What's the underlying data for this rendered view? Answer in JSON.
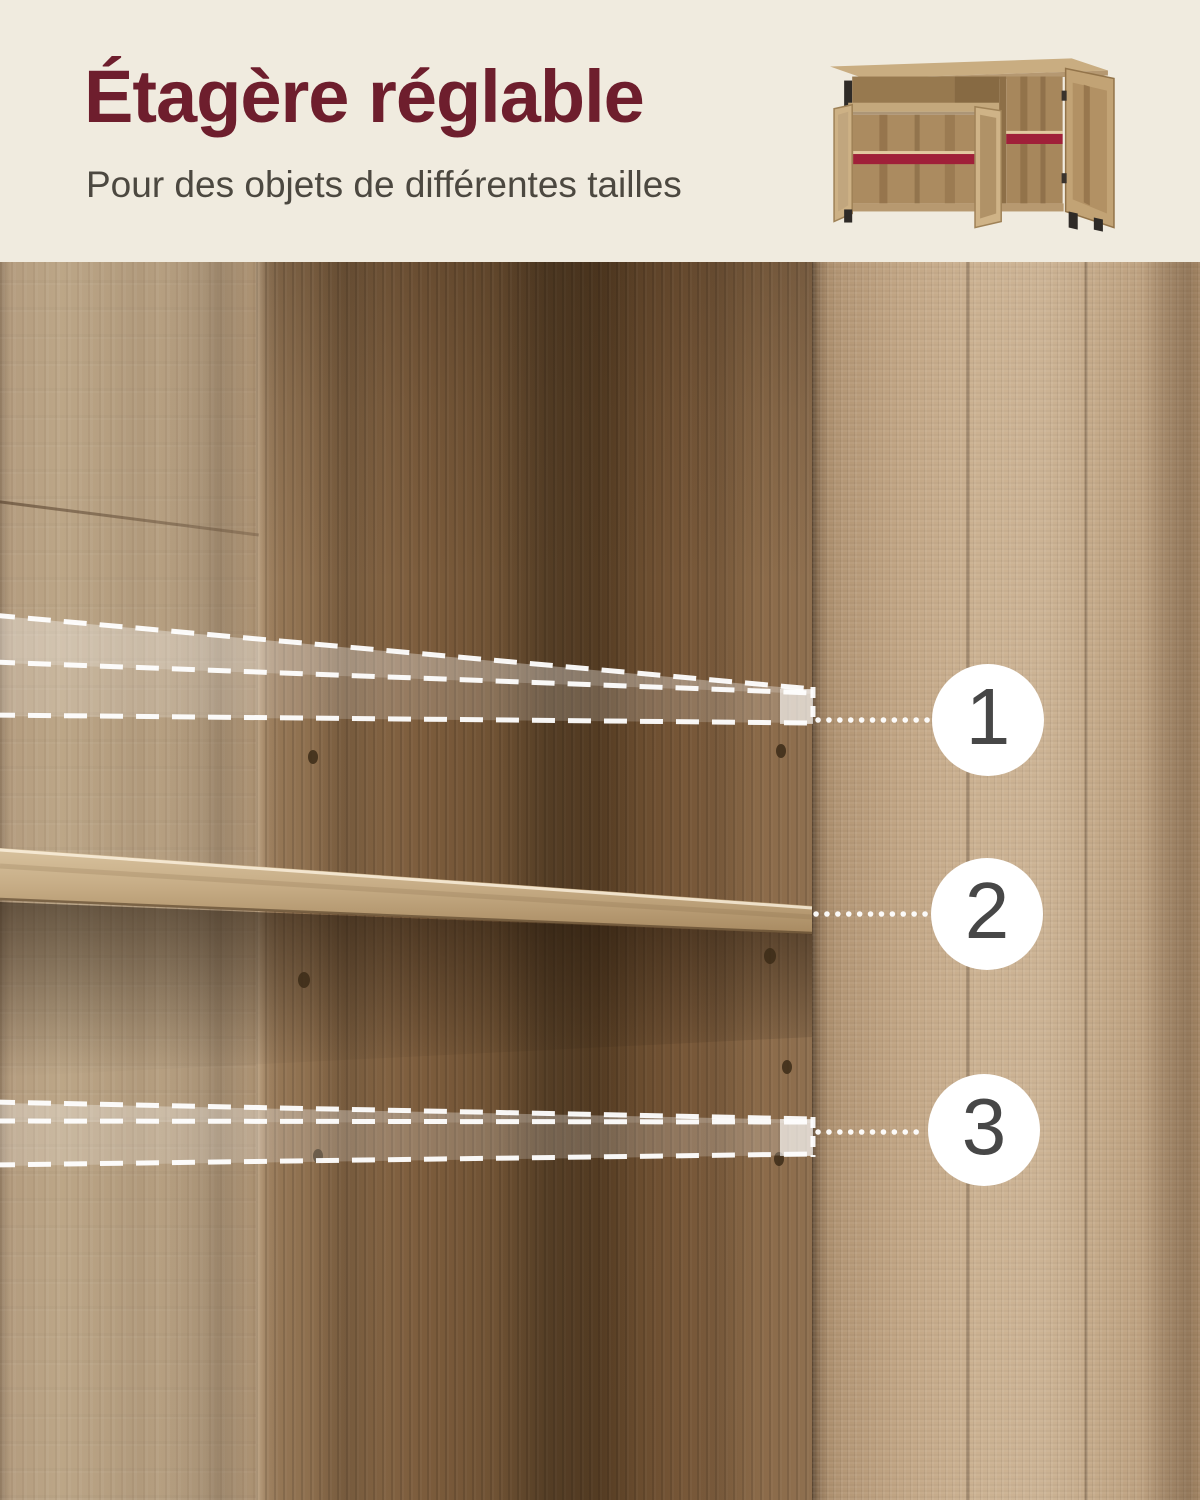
{
  "header": {
    "title": "Étagère réglable",
    "subtitle": "Pour des objets de différentes tailles"
  },
  "annotation": {
    "markers": [
      {
        "label": "1"
      },
      {
        "label": "2"
      },
      {
        "label": "3"
      }
    ]
  },
  "colors": {
    "background_cream": "#f0ebdf",
    "title_maroon": "#6e1e2d",
    "subtitle_gray": "#4c4840",
    "marker_background": "#ffffff",
    "marker_number": "#474747",
    "annotation_white": "#ffffff",
    "thumbnail_red_shelf_accent": "#a02039",
    "wood_light_tan": "#cbb191",
    "wood_medium_brown": "#8a6b4a",
    "wood_dark_brown": "#5d4226"
  },
  "icons": {
    "thumbnail": "product-cabinet-illustration"
  }
}
